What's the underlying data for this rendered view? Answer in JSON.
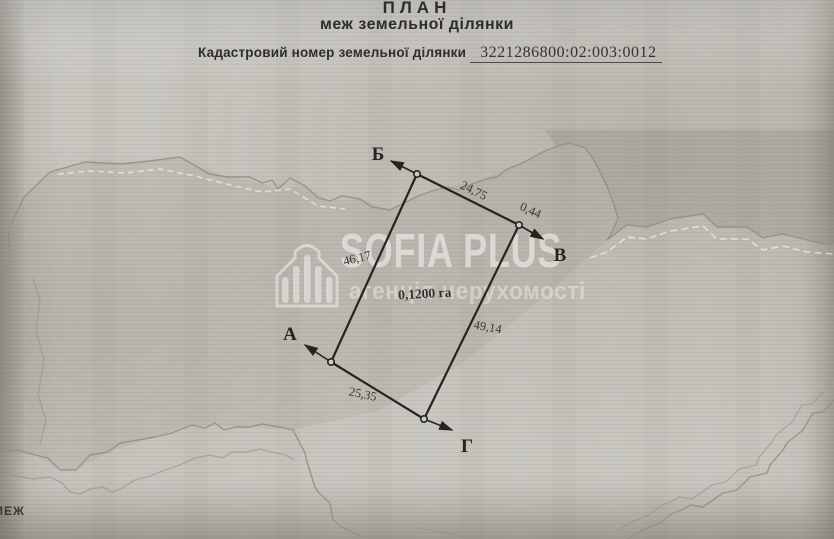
{
  "header": {
    "title": "ПЛАН",
    "subtitle": "меж земельної ділянки",
    "cadastral_label": "Кадастровий номер земельної ділянки",
    "cadastral_number": "3221286800:02:003:0012"
  },
  "plan": {
    "area_label": "0,1200 га",
    "corner_labels": {
      "a": "А",
      "b": "Б",
      "v": "В",
      "g": "Г"
    },
    "side_labels": {
      "ab": "46,17",
      "bv": "24,75",
      "v_short": "0,44",
      "vg": "49,14",
      "ag": "25,35"
    }
  },
  "watermark": {
    "brand": "SOFIA PLUS",
    "tagline": "агенція нерухомості",
    "icon": "building-bars-icon"
  },
  "map_note": "МЕЖ",
  "colors": {
    "paper": "#c7c5be",
    "ink": "#26241f",
    "map_line": "#918e84",
    "watermark_white": "#f0efe9"
  }
}
